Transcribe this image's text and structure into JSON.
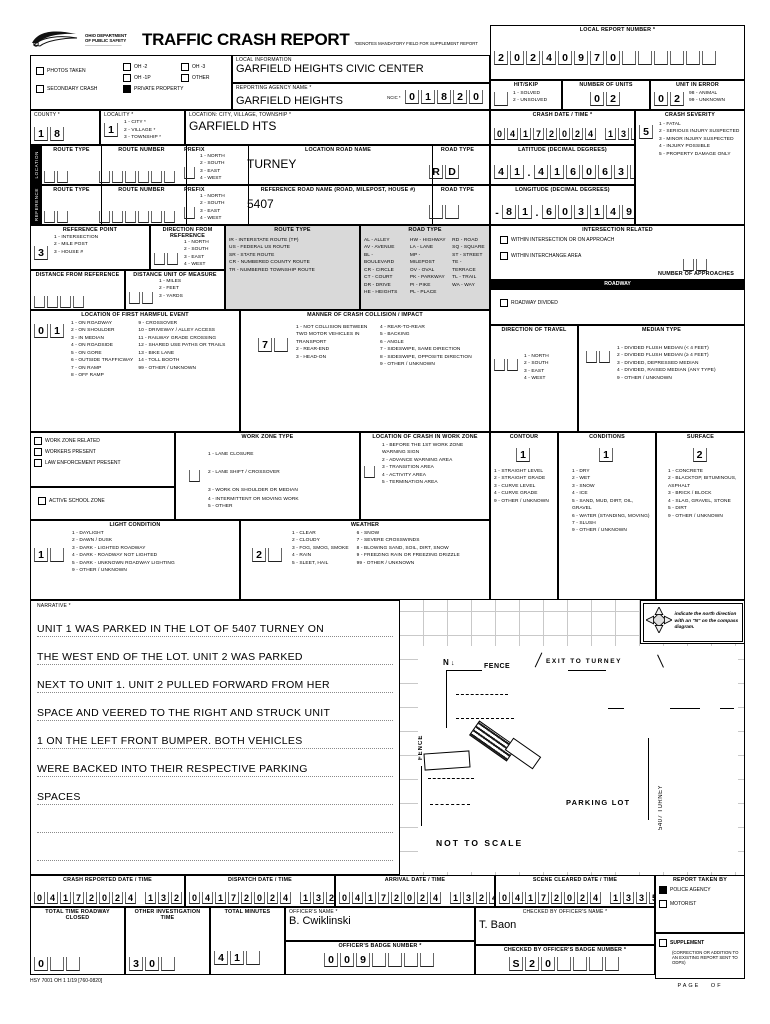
{
  "header": {
    "dept_line1": "OHIO DEPARTMENT",
    "dept_line2": "OF PUBLIC SAFETY",
    "title": "TRAFFIC CRASH REPORT",
    "subtitle": "*DENOTES MANDATORY FIELD FOR SUPPLEMENT REPORT",
    "local_report_label": "LOCAL REPORT NUMBER *",
    "local_report_number": "20240970"
  },
  "checks": {
    "photos": "PHOTOS TAKEN",
    "secondary": "SECONDARY CRASH",
    "oh2": "OH -2",
    "oh3": "OH -3",
    "oh1p": "OH -1P",
    "other": "OTHER",
    "private_property": "PRIVATE PROPERTY"
  },
  "local_info": {
    "label": "LOCAL INFORMATION",
    "value": "GARFIELD HEIGHTS CIVIC CENTER"
  },
  "agency": {
    "label": "REPORTING AGENCY NAME *",
    "value": "GARFIELD HEIGHTS",
    "ncic_label": "NCIC *",
    "ncic": "01820"
  },
  "hit_skip": {
    "label": "HIT/SKIP",
    "opts": "1 - SOLVED\n2 - UNSOLVED",
    "value": ""
  },
  "num_units": {
    "label": "NUMBER OF UNITS",
    "value": "02"
  },
  "unit_in_error": {
    "label": "UNIT IN ERROR",
    "opts": "98 - ANIMAL\n99 - UNKNOWN",
    "value": "02"
  },
  "county": {
    "label": "COUNTY *",
    "value": "18"
  },
  "locality": {
    "label": "LOCALITY *",
    "opts": "1 - CITY *\n2 - VILLAGE *\n3 - TOWNSHIP *",
    "value": "1"
  },
  "location_cvt": {
    "label": "LOCATION: CITY, VILLAGE, TOWNSHIP *",
    "value": "GARFIELD HTS"
  },
  "crash_dt": {
    "label": "CRASH DATE / TIME *",
    "value": "04172024 1320"
  },
  "severity": {
    "label": "CRASH SEVERITY",
    "value": "5",
    "opts": "1 - FATAL\n2 - SERIOUS INJURY SUSPECTED\n3 - MINOR INJURY SUSPECTED\n4 - INJURY POSSIBLE\n5 - PROPERTY DAMAGE ONLY"
  },
  "location_row": {
    "tab": "LOCATION",
    "route_type_label": "ROUTE TYPE",
    "route_type": "",
    "route_number_label": "ROUTE NUMBER",
    "route_number": "",
    "prefix_label": "PREFIX",
    "prefix": "",
    "prefix_opts": "1 - NORTH\n2 - SOUTH\n3 - EAST\n4 - WEST",
    "road_name_label": "LOCATION ROAD NAME",
    "road_name": "TURNEY",
    "road_type_label": "ROAD TYPE",
    "road_type": "RD"
  },
  "reference_row": {
    "tab": "REFERENCE",
    "route_type_label": "ROUTE TYPE",
    "route_type": "",
    "route_number_label": "ROUTE NUMBER",
    "route_number": "",
    "prefix_label": "PREFIX",
    "prefix": "",
    "prefix_opts": "1 - NORTH\n2 - SOUTH\n3 - EAST\n4 - WEST",
    "road_name_label": "REFERENCE ROAD NAME  (ROAD, MILEPOST, HOUSE #)",
    "road_name": "5407",
    "road_type_label": "ROAD TYPE",
    "road_type": ""
  },
  "latitude": {
    "label": "LATITUDE (DECIMAL DEGREES)",
    "value": "41.416063"
  },
  "longitude": {
    "label": "LONGITUDE (DECIMAL DEGREES)",
    "value": "-81.603149"
  },
  "ref_point": {
    "label": "REFERENCE POINT",
    "opts": "1 - INTERSECTION\n2 - MILE POST\n3 - HOUSE #",
    "value": "3"
  },
  "dir_from_ref": {
    "label": "DIRECTION FROM REFERENCE",
    "opts": "1 - NORTH\n2 - SOUTH\n3 - EAST\n4 - WEST",
    "value": ""
  },
  "route_type_legend": {
    "title": "ROUTE TYPE",
    "items": "IR - INTERSTATE ROUTE (TP)\nUS - FEDERAL US ROUTE\nSR - STATE ROUTE\nCR - NUMBERED COUNTY ROUTE\nTR - NUMBERED TOWNSHIP ROUTE"
  },
  "road_type_legend": {
    "title": "ROAD TYPE",
    "col1": "AL - ALLEY\nAV - AVENUE\nBL - BOULEVARD\nCR - CIRCLE\nCT - COURT\nDR - DRIVE\nHE - HEIGHTS",
    "col2": "HW - HIGHWAY\nLA - LANE\nMP - MILEPOST\nOV - OVAL\nPK - PARKWAY\nPI - PIKE\nPL - PLACE",
    "col3": "RD - ROAD\nSQ - SQUARE\nST - STREET\nTE - TERRACE\nTL - TRAIL\nWA - WAY"
  },
  "distance": {
    "label": "DISTANCE FROM REFERENCE",
    "value": ""
  },
  "distance_unit": {
    "label": "DISTANCE UNIT OF MEASURE",
    "opts": "1 - MILES\n2 - FEET\n3 - YARDS",
    "value": ""
  },
  "intersection": {
    "title": "INTERSECTION RELATED",
    "cb1": "WITHIN INTERSECTION OR ON APPROACH",
    "cb2": "WITHIN INTERCHANGE AREA",
    "approaches_label": "NUMBER OF APPROACHES",
    "approaches": ""
  },
  "roadway": {
    "bar": "ROADWAY",
    "divided": "ROADWAY DIVIDED"
  },
  "first_harmful": {
    "title": "LOCATION OF FIRST HARMFUL EVENT",
    "value": "01",
    "col1": "1 - ON ROADWAY\n2 - ON SHOULDER\n3 - IN MEDIAN\n4 - ON ROADSIDE\n5 - ON GORE\n6 - OUTSIDE TRAFFICWAY\n7 - ON RAMP\n8 - OFF RAMP",
    "col2": "9 - CROSSOVER\n10 - DRIVEWAY / ALLEY ACCESS\n11 - RAILWAY GRADE CROSSING\n12 - SHARED USE PATHS OR TRAILS\n13 - BIKE LANE\n14 - TOLL BOOTH\n99 - OTHER / UNKNOWN"
  },
  "manner": {
    "title": "MANNER OF CRASH COLLISION / IMPACT",
    "value": "7",
    "col1": "1 - NOT COLLISION BETWEEN TWO MOTOR VEHICLES IN TRANSPORT\n2 - REAR-END\n3 - HEAD-ON",
    "col2": "4 - REAR-TO-REAR\n5 - BACKING\n6 - ANGLE\n7 - SIDESWIPE, SAME DIRECTION\n8 - SIDESWIPE, OPPOSITE DIRECTION\n9 - OTHER / UNKNOWN"
  },
  "dir_travel": {
    "title": "DIRECTION OF TRAVEL",
    "opts": "1 - NORTH\n2 - SOUTH\n3 - EAST\n4 - WEST",
    "value": ""
  },
  "median": {
    "title": "MEDIAN TYPE",
    "opts": "1 - DIVIDED FLUSH MEDIAN (< 4 FEET)\n2 - DIVIDED FLUSH MEDIAN (≥ 4 FEET)\n3 - DIVIDED, DEPRESSED MEDIAN\n4 - DIVIDED, RAISED MEDIAN (ANY TYPE)\n9 - OTHER / UNKNOWN",
    "value": ""
  },
  "workzone": {
    "cb1": "WORK ZONE RELATED",
    "cb2": "WORKERS PRESENT",
    "cb3": "LAW ENFORCEMENT PRESENT",
    "school": "ACTIVE SCHOOL ZONE"
  },
  "wz_type": {
    "title": "WORK ZONE TYPE",
    "value": "",
    "opts1": "1 - LANE CLOSURE\n2 - LANE SHIFT / CROSSOVER\n3 - WORK ON SHOULDER OR MEDIAN",
    "opts2": "4 - INTERMITTENT OR MOVING WORK\n5 - OTHER"
  },
  "wz_loc": {
    "title": "LOCATION OF CRASH IN WORK ZONE",
    "value": "",
    "opts": "1 - BEFORE THE 1ST WORK ZONE WARNING SIGN\n2 - ADVANCE WARNING AREA\n3 - TRANSITION AREA\n4 - ACTIVITY AREA\n5 - TERMINATION AREA"
  },
  "contour": {
    "title": "CONTOUR",
    "value": "1",
    "opts": "1 - STRAIGHT LEVEL\n2 - STRAIGHT GRADE\n3 - CURVE LEVEL\n4 - CURVE GRADE\n9 - OTHER / UNKNOWN"
  },
  "conditions": {
    "title": "CONDITIONS",
    "value": "1",
    "opts": "1 - DRY\n2 - WET\n3 - SNOW\n4 - ICE\n5 - SAND, MUD, DIRT, OIL, GRAVEL\n6 - WATER (STANDING, MOVING)\n7 - SLUSH\n9 - OTHER / UNKNOWN"
  },
  "surface": {
    "title": "SURFACE",
    "value": "2",
    "opts": "1 - CONCRETE\n2 - BLACKTOP, BITUMINOUS, ASPHALT\n3 - BRICK / BLOCK\n4 - SLAG, GRAVEL, STONE\n5 - DIRT\n9 - OTHER / UNKNOWN"
  },
  "light": {
    "title": "LIGHT CONDITION",
    "value": "1",
    "opts": "1 - DAYLIGHT\n2 - DAWN / DUSK\n3 - DARK - LIGHTED ROADWAY\n4 - DARK - ROADWAY NOT LIGHTED\n5 - DARK - UNKNOWN ROADWAY LIGHTING\n9 - OTHER / UNKNOWN"
  },
  "weather": {
    "title": "WEATHER",
    "value": "2",
    "col1": "1 - CLEAR\n2 - CLOUDY\n3 - FOG, SMOG, SMOKE\n4 - RAIN\n5 - SLEET, HAIL",
    "col2": "6 - SNOW\n7 - SEVERE CROSSWINDS\n8 - BLOWING SAND, SOIL, DIRT, SNOW\n9 - FREEZING RAIN OR FREEZING DRIZZLE\n99 - OTHER / UNKNOWN"
  },
  "narrative": {
    "label": "NARRATIVE *",
    "text": "UNIT 1 WAS PARKED IN THE LOT OF 5407 TURNEY ON\nTHE WEST END OF THE LOT.  UNIT 2 WAS PARKED\nNEXT TO UNIT 1.  UNIT 2 PULLED FORWARD FROM HER\nSPACE AND VEERED TO THE RIGHT AND STRUCK UNIT\n1 ON THE LEFT FRONT BUMPER.  BOTH VEHICLES\nWERE BACKED INTO THEIR RESPECTIVE PARKING\nSPACES\n\n\n"
  },
  "diagram": {
    "compass_note": "indicate the north direction with an \"N\" on the compass diagram.",
    "north_mark": "N",
    "fence_label": "FENCE",
    "fence_side_label": "FENCE",
    "exit_label": "EXIT TO TURNEY",
    "street_label": "5407 TURNEY",
    "parking_label": "PARKING LOT",
    "scale_label": "NOT TO SCALE"
  },
  "times": {
    "reported_label": "CRASH REPORTED DATE / TIME",
    "reported": "04172024 1320",
    "dispatch_label": "DISPATCH DATE / TIME",
    "dispatch": "04172024 1320",
    "arrival_label": "ARRIVAL DATE / TIME",
    "arrival": "04172024 1324",
    "cleared_label": "SCENE CLEARED DATE / TIME",
    "cleared": "04172024 1335"
  },
  "report_taken": {
    "title": "REPORT TAKEN BY",
    "police": "POLICE AGENCY",
    "motorist": "MOTORIST",
    "supplement": "SUPPLEMENT",
    "supplement_note": "(CORRECTION OR ADDITION TO AN EXISTING REPORT SENT TO ODPS)"
  },
  "totals": {
    "closed_label": "TOTAL TIME ROADWAY CLOSED",
    "closed": "0",
    "other_label": "OTHER INVESTIGATION TIME",
    "other": "30",
    "minutes_label": "TOTAL MINUTES",
    "minutes": "41"
  },
  "officers": {
    "name_label": "OFFICER'S NAME *",
    "name": "B.  Cwiklinski",
    "badge_label": "OFFICER'S BADGE NUMBER *",
    "badge": "009",
    "checked_name_label": "CHECKED BY OFFICER'S NAME *",
    "checked_name": "T. Baon",
    "checked_badge_label": "CHECKED BY OFFICER'S BADGE NUMBER *",
    "checked_badge": "S20"
  },
  "footer": {
    "form_code": "HSY 7001 OH 1  1/19 [760-0820]",
    "page": "PAGE",
    "of": "OF"
  }
}
